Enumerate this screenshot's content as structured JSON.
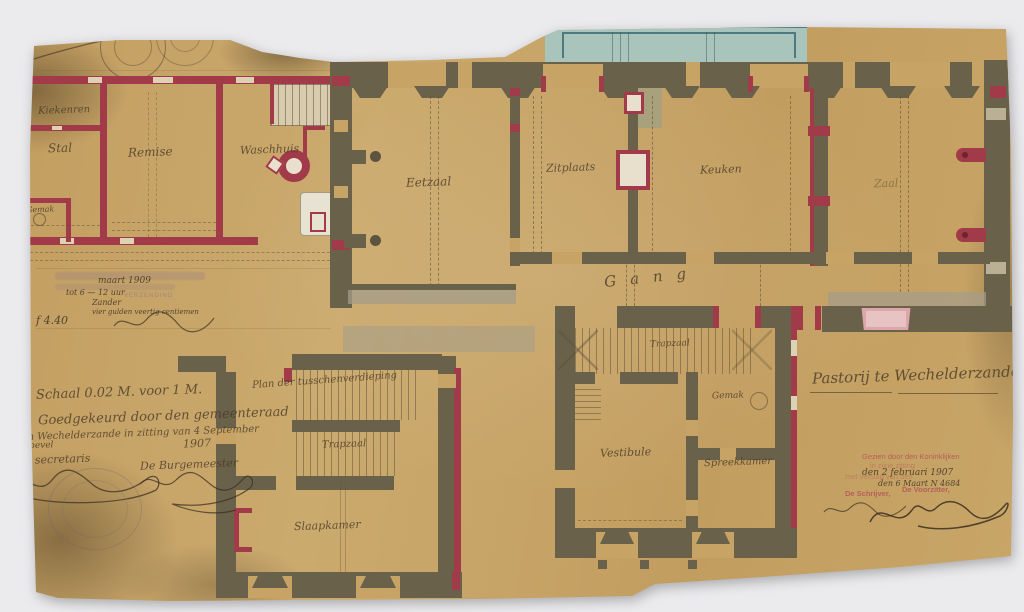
{
  "sheet": {
    "number": "N 4",
    "heading": "Plan",
    "title": "Pastorij te Wechelderzande",
    "paper_color": "#c6a264",
    "wall_existing_color": "#6a614b",
    "wall_new_color": "#a23b49",
    "veranda_wash_color": "#a9c4bb",
    "window_wash_color": "#dba7ab"
  },
  "rooms": {
    "left_wing": {
      "coop": "Kiekenren",
      "stable": "Stal",
      "carriage_house": "Remise",
      "wash_house": "Waschhuis",
      "privy": "Gemak"
    },
    "main_floor": {
      "dining_room": "Eetzaal",
      "sitting_room": "Zitplaats",
      "kitchen": "Keuken",
      "hall": "Zaal",
      "corridor": "Gang",
      "stair_hall": "Trapzaal",
      "privy": "Gemak",
      "vestibule": "Vestibule",
      "parlour": "Spreekkamer"
    },
    "mezzanine": {
      "heading": "Plan der tusschenverdieping",
      "stair_hall": "Trapzaal",
      "bedroom": "Slaapkamer"
    }
  },
  "notes": {
    "scale": "Schaal 0.02 M. voor 1 M.",
    "approval_line1": "Goedgekeurd door den gemeenteraad",
    "approval_line2": "van Wechelderzande in zitting van 4 September",
    "approval_line3": "Bij bevel",
    "approval_year": "1907",
    "secretary_label": "De secretaris",
    "mayor_label": "De Burgemeester"
  },
  "registration_stamp": {
    "legible_word": "VERZENDING",
    "written_date": "maart 1909",
    "written_time": "tot 6 — 12 uur",
    "written_name": "Zander",
    "written_amount": "vier gulden veertig centiemen",
    "fee": "f 4.40"
  },
  "commission_stamp": {
    "line1": "Gezien door den Koninklijken",
    "line2": "in zijne zitting",
    "line3": "met verslag van den",
    "written_date": "den 2 februari 1907",
    "written_ref": "den 6 Maart  N 4684",
    "clerk_label": "De Schrijver,",
    "chairman_label": "De Voorzitter,"
  }
}
